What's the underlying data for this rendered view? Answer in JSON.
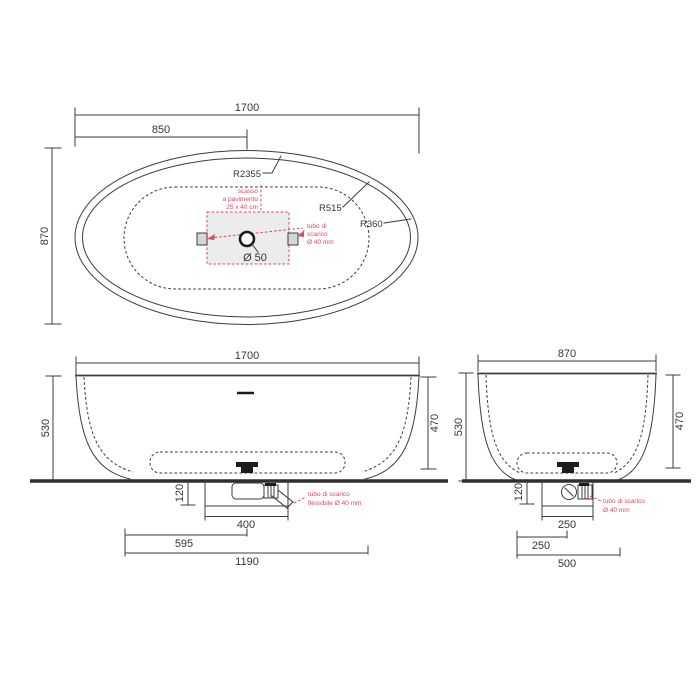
{
  "drawing": {
    "type": "bathtub technical drawing, three orthographic views",
    "colors": {
      "line": "#3d3d3d",
      "accent_red": "#e2485f",
      "recess_fill": "#ececec"
    }
  },
  "top_view": {
    "width": "1700",
    "half_width": "850",
    "depth": "870",
    "r_outer": "R2355",
    "r_mid": "R515",
    "r_corner": "R360",
    "drain_hole": "Ø 50",
    "recess_note": [
      "scasso",
      "a pavimento",
      "25 x 40 cm"
    ],
    "drain_note": [
      "tubo di",
      "scarico",
      "Ø 40 mm"
    ]
  },
  "front_view": {
    "width": "1700",
    "height": "530",
    "inner_depth": "470",
    "recess_depth": "120",
    "recess_width": "400",
    "drain_offset": "595",
    "base_width": "1190",
    "drain_note": [
      "tubo di scarico",
      "flessibile Ø 40 mm"
    ]
  },
  "side_view": {
    "width": "870",
    "height": "530",
    "inner_depth": "470",
    "recess_depth": "120",
    "recess_width": "250",
    "drain_offset": "250",
    "base_width": "500",
    "drain_note": [
      "tubo di scarico",
      "Ø 40 mm"
    ]
  }
}
